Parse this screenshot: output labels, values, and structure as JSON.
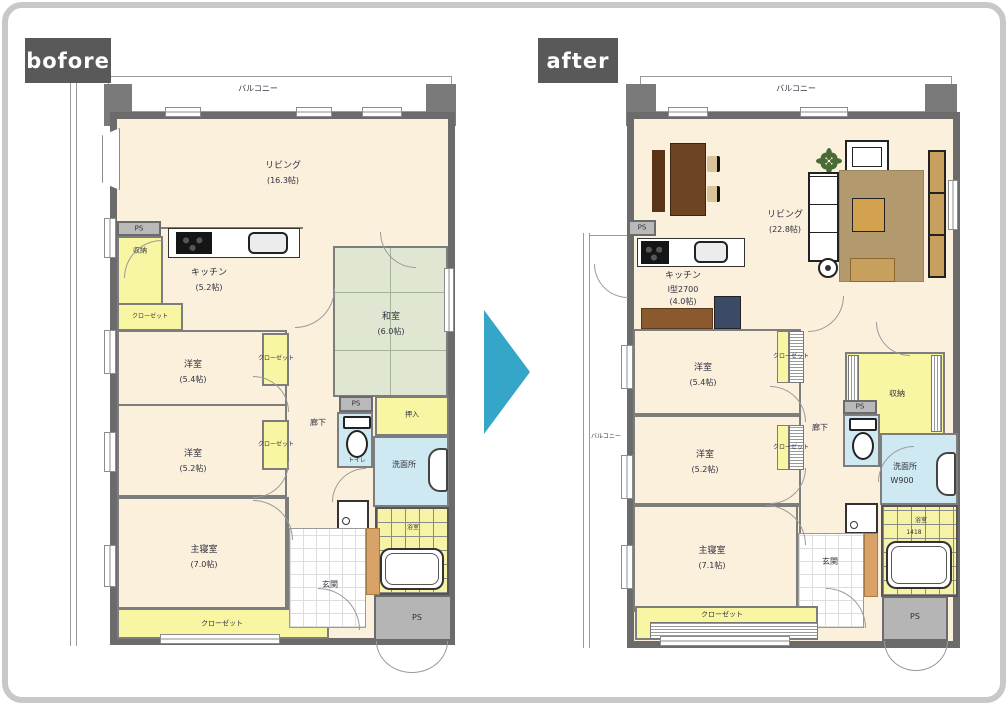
{
  "badges": {
    "before": "bofore",
    "after": "after",
    "bg": "#595959"
  },
  "arrow": {
    "direction": "right",
    "color": "#35a5c8"
  },
  "colors": {
    "wall": "#6b6b6b",
    "room_floor": "#faf0dc",
    "tatami": "#dfe7d3",
    "closet_yellow": "#f8f6a2",
    "wet_blue": "#cfe9f2",
    "card_border": "#c8c8c8"
  },
  "icons": [
    "toilet-icon",
    "bathtub-icon",
    "washbasin-icon",
    "kitchen-sink-icon",
    "stove-icon",
    "washing-machine-icon",
    "plant-icon",
    "sofa-icon",
    "armchair-icon",
    "dining-table-icon",
    "coffee-table-icon",
    "tv-board-icon",
    "robot-vacuum-icon",
    "door-arc",
    "window"
  ],
  "before": {
    "balcony_top": "バルコニー",
    "living_name": "リビング",
    "living_area": "(16.3帖)",
    "kitchen_name": "キッチン",
    "kitchen_area": "(5.2帖)",
    "washitsu_name": "和室",
    "washitsu_area": "(6.0帖)",
    "bed1_name": "洋室",
    "bed1_area": "(5.4帖)",
    "bed2_name": "洋室",
    "bed2_area": "(5.2帖)",
    "master_name": "主寝室",
    "master_area": "(7.0帖)",
    "ps_top": "PS",
    "ps_mid": "PS",
    "ps_bottom": "PS",
    "shuno_top": "収納",
    "shuno_side": "収納",
    "closet_kitchen": "クローゼット",
    "closet_bed1": "クローゼット",
    "closet_bed2": "クローゼット",
    "closet_bottom": "クローゼット",
    "hall": "廊下",
    "toilet": "トイレ",
    "oshiire": "押入",
    "senmen": "洗面所",
    "bath": "浴室",
    "genkan": "玄関"
  },
  "after": {
    "balcony_top": "バルコニー",
    "balcony_left": "バルコニー",
    "living_name": "リビング",
    "living_area": "(22.8帖)",
    "kitchen_name": "キッチン",
    "kitchen_type": "I型2700",
    "kitchen_area": "(4.0帖)",
    "bed1_name": "洋室",
    "bed1_area": "(5.4帖)",
    "bed2_name": "洋室",
    "bed2_area": "(5.2帖)",
    "master_name": "主寝室",
    "master_area": "(7.1帖)",
    "ps_left": "PS",
    "ps_mid": "PS",
    "ps_bottom": "PS",
    "shuno": "収納",
    "closet_bed1": "クローゼット",
    "closet_bed2": "クローゼット",
    "closet_bottom": "クローゼット",
    "hall": "廊下",
    "senmen_name": "洗面所",
    "senmen_size": "W900",
    "bath_name": "浴室",
    "bath_size": "1418",
    "genkan": "玄関"
  }
}
